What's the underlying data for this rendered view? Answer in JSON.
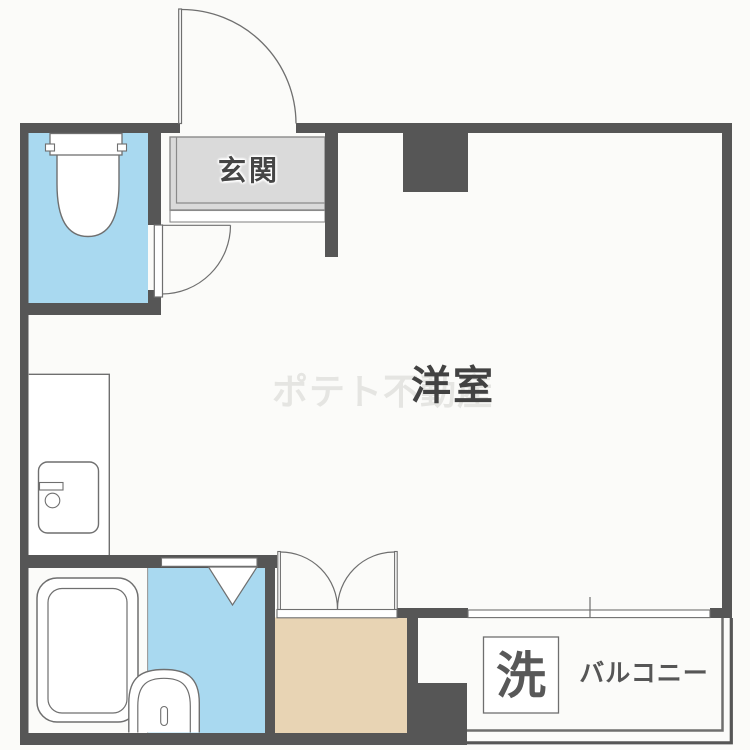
{
  "plan": {
    "labels": {
      "entrance": "玄関",
      "western_room": "洋室",
      "washer": "洗",
      "balcony": "バルコニー"
    },
    "watermark": "ポテト不動産",
    "colors": {
      "wall": "#565656",
      "water": "#a9d9f0",
      "closet": "#e8d4b4",
      "entrance_floor": "#dadada",
      "outline": "#6f6f6f",
      "label_text": "#444444",
      "background": "#fbfbf9"
    }
  }
}
